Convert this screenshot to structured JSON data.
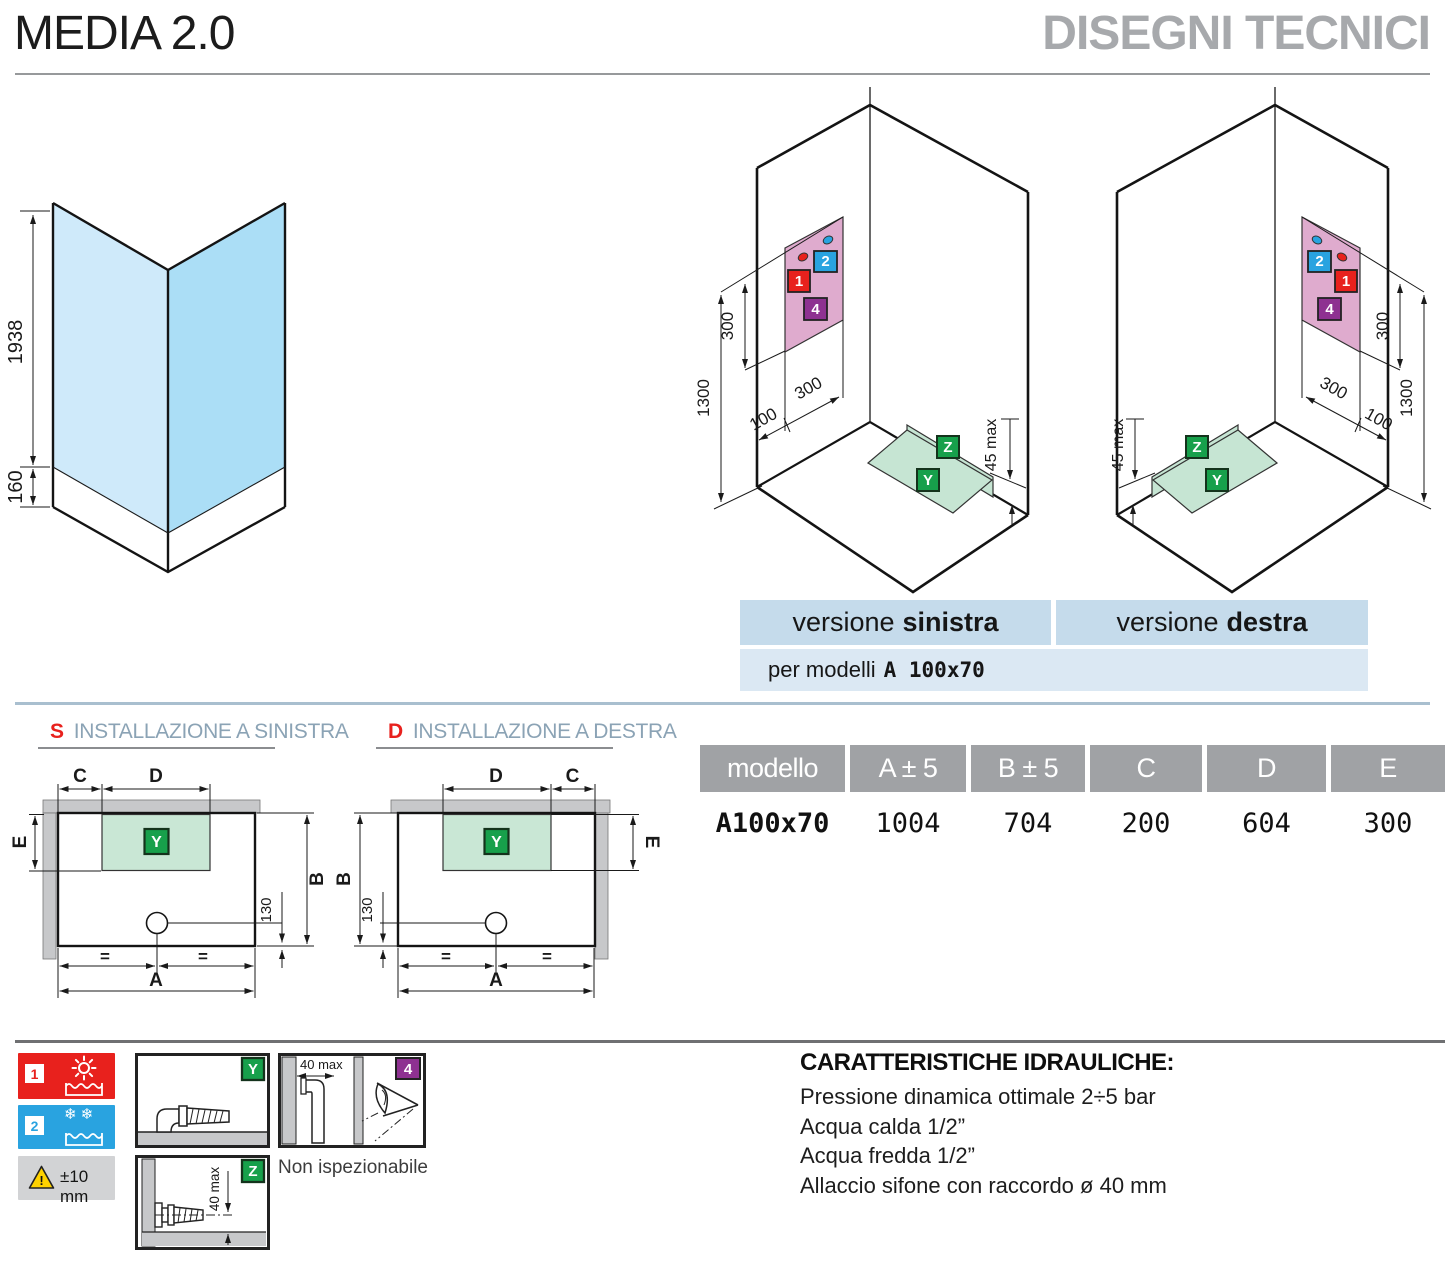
{
  "header": {
    "title": "MEDIA 2.0",
    "section": "DISEGNI TECNICI"
  },
  "glass_diagram": {
    "height": "1938",
    "base": "160"
  },
  "iso": {
    "d300": "300",
    "d1300": "1300",
    "d100": "100",
    "d45": "45 max",
    "box1": "1",
    "box2": "2",
    "box4": "4",
    "boxY": "Y",
    "boxZ": "Z",
    "left_name": "versione sinistra",
    "right_name": "versione destra"
  },
  "versions": {
    "v_label": "versione",
    "left": "sinistra",
    "right": "destra",
    "models_label": "per modelli",
    "model": "A 100x70"
  },
  "plans": {
    "s_letter": "S",
    "s_title": "INSTALLAZIONE A SINISTRA",
    "d_letter": "D",
    "d_title": "INSTALLAZIONE A DESTRA",
    "dim_a": "A",
    "dim_b": "B",
    "dim_c": "C",
    "dim_d": "D",
    "dim_e": "E",
    "dim_130": "130",
    "eq": "=",
    "boxY": "Y"
  },
  "table": {
    "headers": [
      "modello",
      "A ± 5",
      "B ± 5",
      "C",
      "D",
      "E"
    ],
    "row": [
      "A100x70",
      "1004",
      "704",
      "200",
      "604",
      "300"
    ]
  },
  "legend": {
    "one": "1",
    "two": "2",
    "tolerance": "±10 mm",
    "snowflakes": "❄❄",
    "y": "Y",
    "z": "Z",
    "four": "4",
    "z_dim": "40 max",
    "four_dim": "40 max",
    "note": "Non ispezionabile"
  },
  "hydraulics": {
    "title": "CARATTERISTICHE IDRAULICHE:",
    "l1": "Pressione dinamica ottimale 2÷5 bar",
    "l2": "Acqua calda 1/2”",
    "l3": "Acqua fredda 1/2”",
    "l4": "Allaccio sifone con raccordo ø 40 mm"
  },
  "colors": {
    "accent_red": "#e8211d",
    "accent_blue": "#29a3e0",
    "accent_purple": "#8e3191",
    "accent_green": "#17a04b",
    "green_light": "#c6e5d3",
    "pink_panel": "#dfabce",
    "glass_light": "#cfeafa",
    "glass_dark": "#abdef6",
    "bar_blue": "#c5dbeb",
    "bar_blue_light": "#dbe8f3",
    "wall_gray": "#c7c8ca",
    "table_header_gray": "#a0a2a5",
    "divider_blue": "#a9bfcf",
    "divider_dark": "#6f7072",
    "section_gray": "#a7a9ac"
  }
}
